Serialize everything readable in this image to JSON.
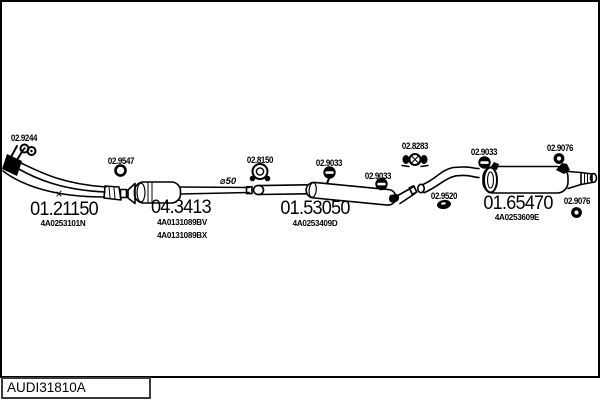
{
  "title_block": {
    "drawing_code": "AUDI31810A"
  },
  "diagram": {
    "annotations": {
      "pipe_diameter": "⌀50"
    },
    "parts": {
      "front_pipe": {
        "number": "01.21150",
        "oe_ref": "4A0253101N"
      },
      "catalytic_converter": {
        "number": "04.3413",
        "oe_ref_1": "4A0131089BV",
        "oe_ref_2": "4A0131089BX"
      },
      "centre_silencer": {
        "number": "01.53050",
        "oe_ref": "4A0253409D"
      },
      "rear_silencer": {
        "number": "01.65470",
        "oe_ref": "4A0253609E"
      }
    },
    "fittings": {
      "front_gasket": "02.9244",
      "seal_ring": "02.9547",
      "clamp_front": "02.8150",
      "rubber_hanger_1": "02.9033",
      "rubber_hanger_2": "02.9033",
      "clamp_rear": "02.8283",
      "rubber_hanger_3": "02.9033",
      "ring_hanger_upper": "02.9076",
      "oval_gasket": "02.9520",
      "ring_hanger_lower": "02.9076"
    }
  },
  "colors": {
    "line": "#000000",
    "background": "#ffffff"
  }
}
